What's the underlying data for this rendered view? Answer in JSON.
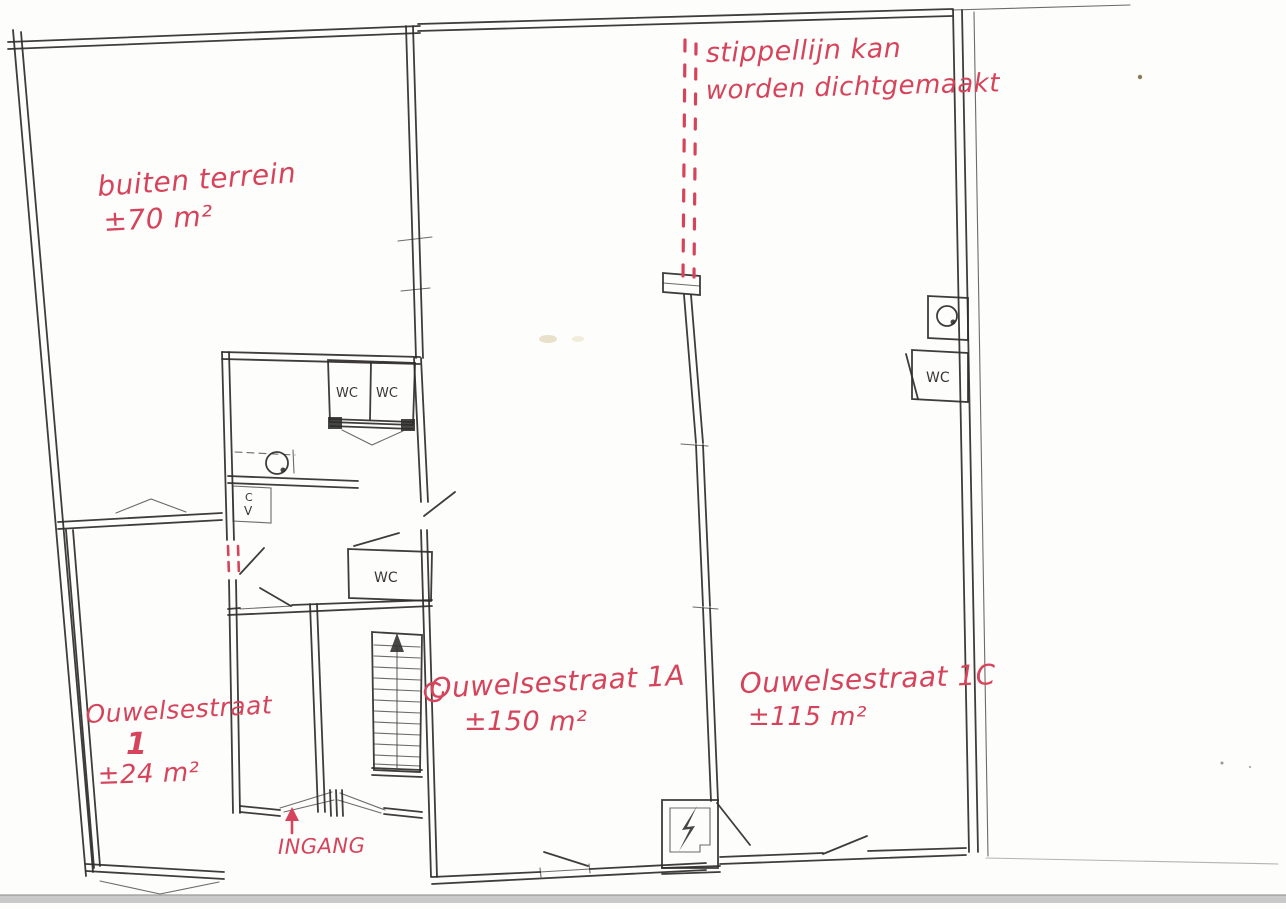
{
  "colors": {
    "annotation_red": "#d6445c",
    "ink": "#2f2c29",
    "paper": "#fdfdfb",
    "scan_edge": "#c9c9c9"
  },
  "annotations": {
    "dotted_line_note_line1": "stippellijn kan",
    "dotted_line_note_line2": "worden dichtgemaakt",
    "outdoor_area_label": "buiten terrein",
    "outdoor_area_size": "±70 m²",
    "unit_1_street": "Ouwelsestraat",
    "unit_1_number": "1",
    "unit_1_size": "±24 m²",
    "unit_1a_label": "Ouwelsestraat 1A",
    "unit_1a_size": "±150 m²",
    "unit_1c_label": "Ouwelsestraat 1C",
    "unit_1c_size": "±115 m²",
    "entrance_label": "INGANG"
  },
  "plan_labels": {
    "wc": "WC",
    "cv_letter_top": "C",
    "cv_letter_bottom": "V"
  }
}
